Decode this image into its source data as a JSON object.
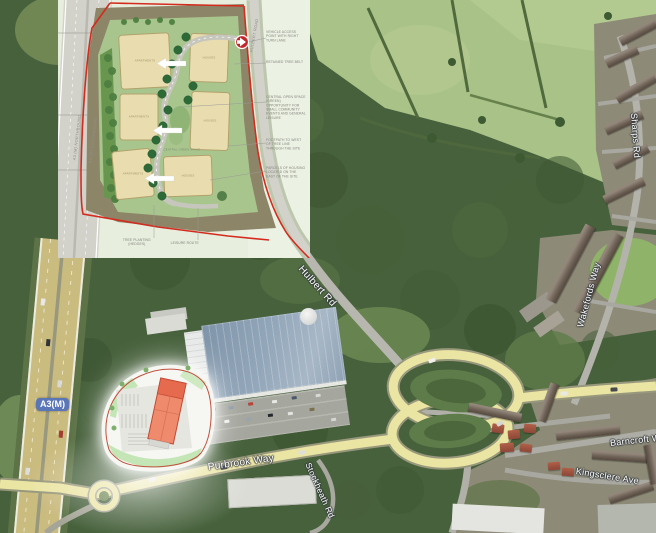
{
  "map": {
    "motorway_shield": "A3(M)",
    "road_labels": {
      "hulbert": "Hulbert Rd",
      "purbrook": "Purbrook Way",
      "wakefords": "Wakefords Way",
      "sharps": "Sharps Rd",
      "barncroft": "Barncroft Way",
      "kingsclere": "Kingsclere Ave",
      "stockheath": "Stockheath Rd"
    },
    "colors": {
      "shield_blue": "#5b76b7",
      "primary_road_yellow": "#ebe5a4",
      "minor_road_grey": "#b5b5ad"
    }
  },
  "masterplan": {
    "boundary_color": "#d42b1e",
    "road_labels": {
      "northbound": "A3 (M) NORTHBOUND",
      "southbound": "A3 (M) SOUTHBOUND",
      "hulbert": "HULBERT ROAD"
    },
    "parcels": [
      {
        "label": "APARTMENTS"
      },
      {
        "label": "HOUSES"
      },
      {
        "label": "APARTMENTS"
      },
      {
        "label": "HOUSES"
      },
      {
        "label": "APARTMENTS"
      },
      {
        "label": "HOUSES"
      }
    ],
    "center_label": "CENTRAL GREEN SPACE",
    "annotations": [
      "VEHICLE ACCESS POINT WITH RIGHT TURN LANE",
      "RETAINED TREE BELT",
      "CENTRAL OPEN SPACE (GREEN) OPPORTUNITY FOR SMALL COMMUNITY EVENTS AND GENERAL LEISURE",
      "FOOTPATH TO WEST OF TREE LINE THROUGH THE SITE",
      "PARCELS OF HOUSING LOCATED ON THE EAST OF THE SITE",
      "TREE PLANTING (HEDGES)",
      "LEISURE ROUTE"
    ]
  }
}
